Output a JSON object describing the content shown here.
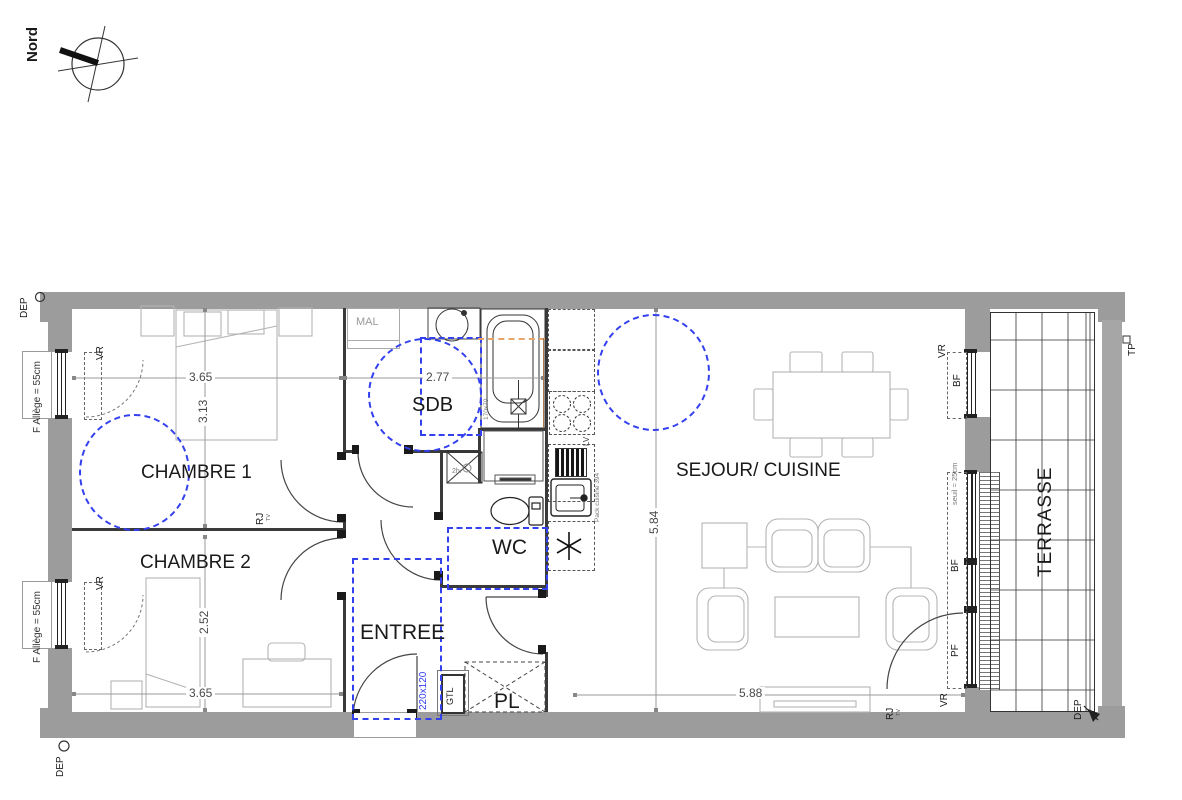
{
  "colors": {
    "accent_blue": "#3340ee",
    "wall_gray": "#9c9c9c",
    "furniture_gray": "#b4b4b4",
    "orange_dash": "#e8a468"
  },
  "compass": {
    "label": "Nord"
  },
  "rooms": {
    "chambre1": "CHAMBRE 1",
    "chambre2": "CHAMBRE 2",
    "sdb": "SDB",
    "wc": "WC",
    "entree": "ENTREE",
    "pl": "PL",
    "sejour": "SEJOUR/ CUISINE",
    "terrasse": "TERRASSE"
  },
  "dims": {
    "ch1_w": "3.65",
    "ch1_h": "3.13",
    "sdb_w": "2.77",
    "ch2_h": "2.52",
    "ch2_w": "3.65",
    "sej_h": "5.84",
    "sej_w": "5.88"
  },
  "ann": {
    "vr": "VR",
    "bf": "BF",
    "pf": "PF",
    "dep": "DEP",
    "tp": "TP",
    "rj": "RJ",
    "tv": "TV",
    "mal": "MAL",
    "gtl": "GTL",
    "lv": "LV",
    "f_allege": "F Allège = 55cm",
    "seuil": "seuil = 25cm",
    "size_220": "220x120",
    "tub_size": "170x70",
    "pack_cuisine": "Pack cuisine 394",
    "wash_note": "2h."
  }
}
